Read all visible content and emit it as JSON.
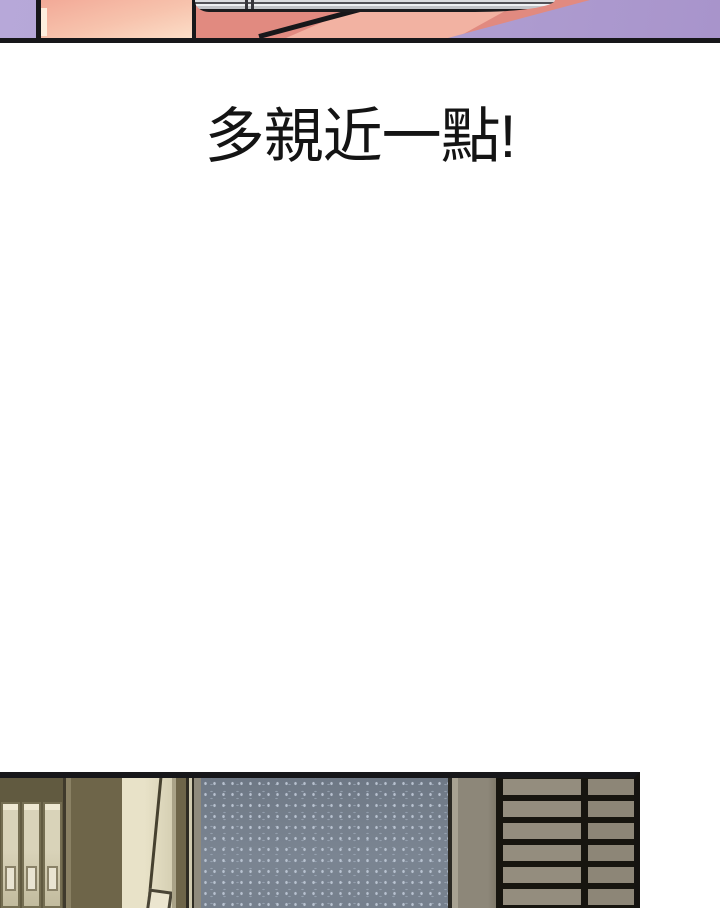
{
  "caption": {
    "text": "多親近一點!"
  },
  "palette": {
    "page_background": "#ffffff",
    "panel_outline": "#17171a",
    "top_panel_purple": "#ae9ed0",
    "skin_light": "#f8c9b2",
    "skin_salmon": "#e18a80",
    "skin_highlight": "#f2b2a2",
    "phone_edge_silver": "#d9dadd",
    "bottom_wall_olive": "#6e6549",
    "binder_beige": "#d9d3b9",
    "binder_label": "#e9e4d2",
    "pillar_beige": "#ded8be",
    "speckled_wall_blue": "#76808d",
    "speckle_dot": "#aab4c2",
    "gray_column": "#8d8779",
    "drawer_slat_gray": "#948d7e",
    "drawer_gap_black": "#17150f"
  },
  "scene": {
    "top_panel": [
      "purple-background",
      "leg",
      "thigh",
      "phone-edge"
    ],
    "bottom_panel": [
      "shelf-binders",
      "olive-wall",
      "door-pillar",
      "paper-sheet",
      "speckled-wall",
      "gray-column",
      "drawer-grid"
    ]
  }
}
